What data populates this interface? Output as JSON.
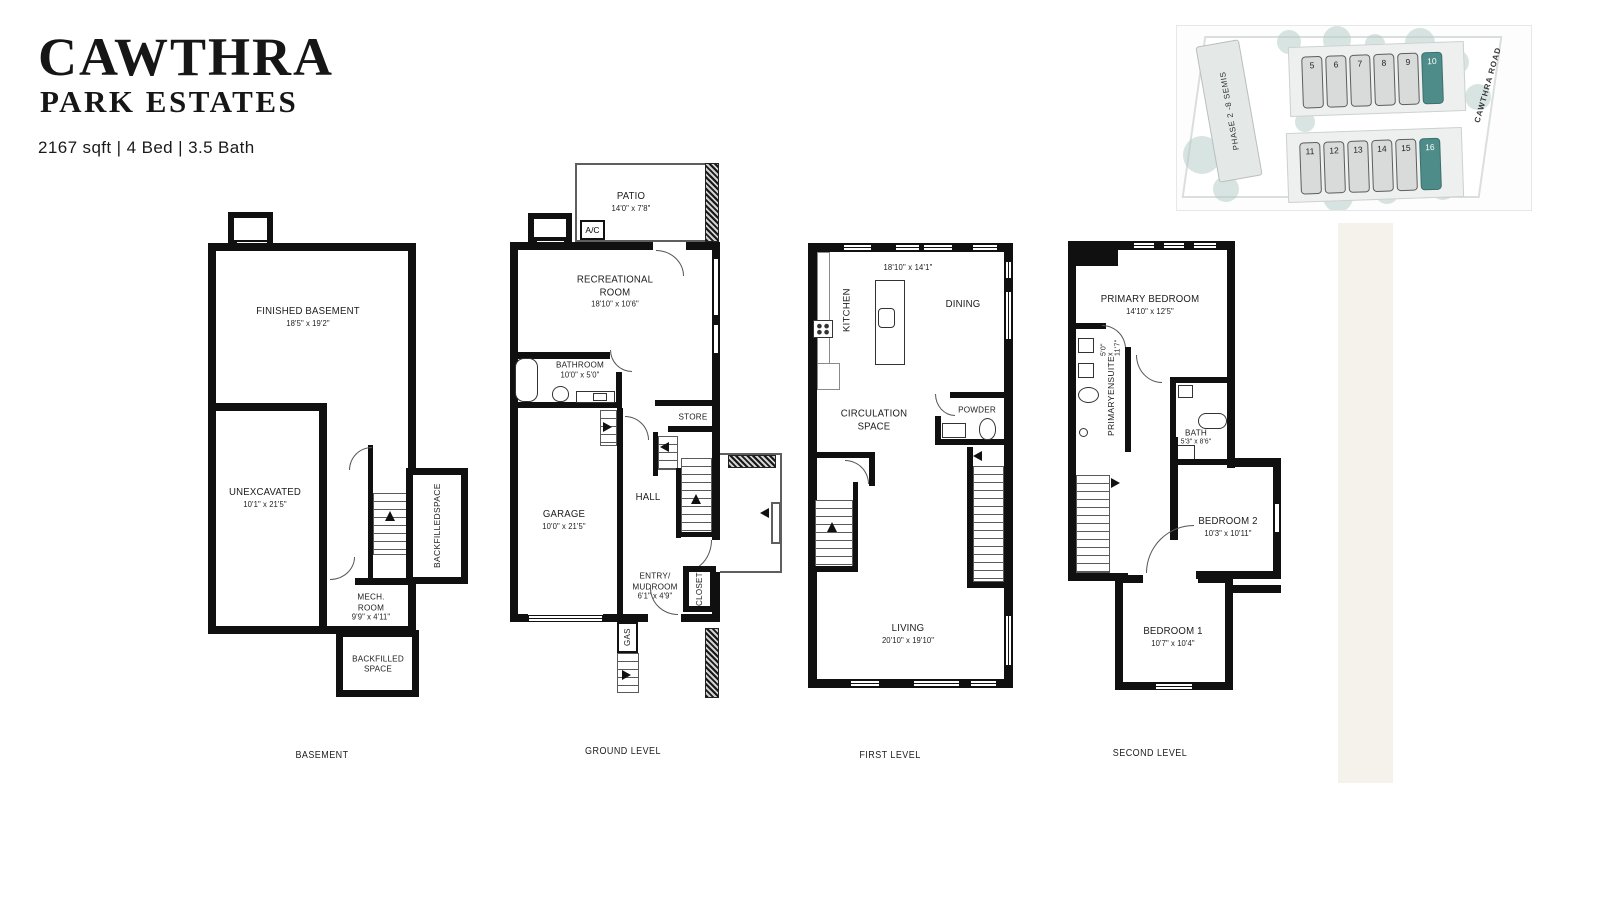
{
  "header": {
    "title_line1": "CAWTHRA",
    "title_line2": "PARK ESTATES",
    "specs": "2167 sqft | 4 Bed | 3.5 Bath"
  },
  "sitemap": {
    "phase_label": "PHASE 2 -8 SEMIS",
    "road_label": "CAWTHRA ROAD",
    "lots_row1": [
      "5",
      "6",
      "7",
      "8",
      "9",
      "10"
    ],
    "lots_row2": [
      "11",
      "12",
      "13",
      "14",
      "15",
      "16"
    ],
    "highlighted_lots": [
      "10",
      "16"
    ],
    "lot_fill": "#d8dbda",
    "lot_highlight": "#4d8c89",
    "tree_color": "#b7cec8"
  },
  "floors": {
    "basement": {
      "label": "BASEMENT",
      "finished": {
        "name": "FINISHED BASEMENT",
        "dims": "18'5\" x 19'2\""
      },
      "unexcavated": {
        "name": "UNEXCAVATED",
        "dims": "10'1\" x 21'5\""
      },
      "mech": {
        "line1": "MECH.",
        "line2": "ROOM",
        "dims": "9'9\" x 4'11\""
      },
      "backfilled_side": {
        "line1": "BACKFILLED",
        "line2": "SPACE"
      },
      "backfilled_bottom": {
        "line1": "BACKFILLED",
        "line2": "SPACE"
      }
    },
    "ground": {
      "label": "GROUND LEVEL",
      "patio": {
        "name": "PATIO",
        "dims": "14'0\" x 7'8\""
      },
      "ac": "A/C",
      "rec": {
        "line1": "RECREATIONAL",
        "line2": "ROOM",
        "dims": "18'10\" x 10'6\""
      },
      "bathroom": {
        "name": "BATHROOM",
        "dims": "10'0\" x 5'0\""
      },
      "garage": {
        "name": "GARAGE",
        "dims": "10'0\" x 21'5\""
      },
      "store": "STORE",
      "hall": "HALL",
      "entry": {
        "line1": "ENTRY/",
        "line2": "MUDROOM",
        "dims": "6'1\" x 4'9\""
      },
      "closet": "CLOSET",
      "gas": "GAS"
    },
    "first": {
      "label": "FIRST LEVEL",
      "dims_top": "18'10\" x 14'1\"",
      "kitchen": "KITCHEN",
      "dining": "DINING",
      "circulation": {
        "line1": "CIRCULATION",
        "line2": "SPACE"
      },
      "powder": "POWDER",
      "living": {
        "name": "LIVING",
        "dims": "20'10\" x 19'10\""
      }
    },
    "second": {
      "label": "SECOND LEVEL",
      "primary": {
        "name": "PRIMARY BEDROOM",
        "dims": "14'10\" x 12'5\""
      },
      "ensuite": {
        "line1": "PRIMARY",
        "line2": "ENSUITE",
        "dims": "5'0\" x 11'7\""
      },
      "bath": {
        "name": "BATH",
        "dims": "5'3\" x 8'6\""
      },
      "bedroom2": {
        "name": "BEDROOM 2",
        "dims": "10'3\" x 10'11\""
      },
      "bedroom1": {
        "name": "BEDROOM 1",
        "dims": "10'7\" x 10'4\""
      }
    }
  }
}
